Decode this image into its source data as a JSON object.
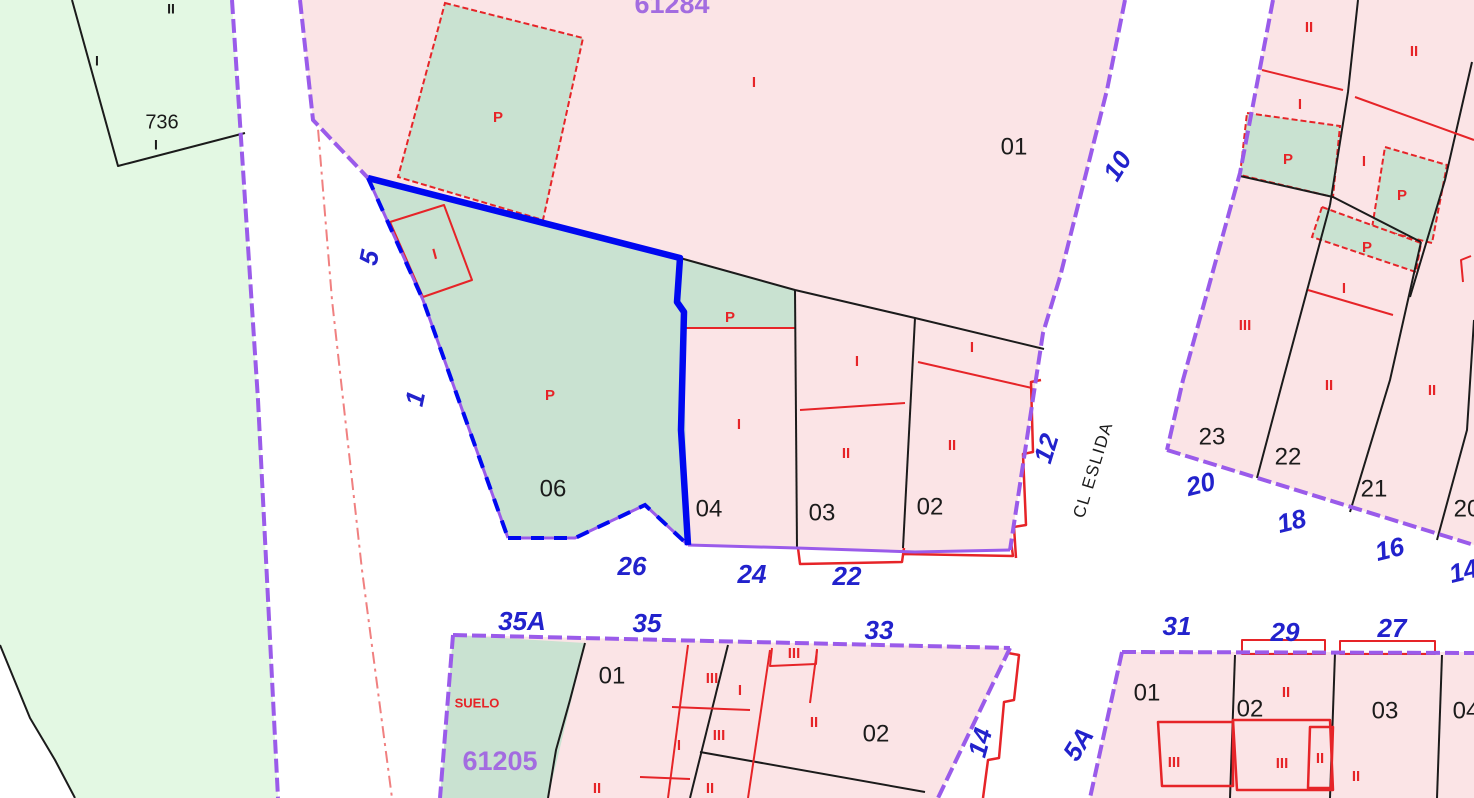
{
  "map_type": "cadastral-parcel-map",
  "palette": {
    "parcel_pink": "#fbe4e6",
    "parcel_sage_green": "#c9e2d1",
    "rural_green": "#e3f8e3",
    "road_white": "#ffffff",
    "boundary_purple": "#9a5bea",
    "block_number_purple": "#a36ce0",
    "street_number_blue": "#2222cc",
    "selection_blue": "#0008f0",
    "subparcel_red": "#e62428",
    "line_black": "#1b1b1b"
  },
  "street": {
    "name": "CL ESLIDA"
  },
  "blocks": {
    "top_center": "61284",
    "bottom_left": "61205"
  },
  "selected_parcel": "06",
  "labels": {
    "black": [
      "736",
      "II",
      "I",
      "I",
      "01",
      "06",
      "04",
      "03",
      "02",
      "23",
      "22",
      "21",
      "20",
      "01",
      "02",
      "01",
      "02",
      "03",
      "04",
      "CL ESLIDA"
    ],
    "blue": [
      "26",
      "24",
      "22",
      "35A",
      "35",
      "33",
      "31",
      "29",
      "27",
      "20",
      "18",
      "16",
      "14",
      "12",
      "10",
      "5",
      "1",
      "5A",
      "14"
    ],
    "purple": [
      "61284",
      "61205"
    ],
    "red": [
      "P",
      "P",
      "P",
      "I",
      "I",
      "I",
      "I",
      "II",
      "I",
      "II",
      "II",
      "II",
      "I",
      "P",
      "I",
      "P",
      "P",
      "I",
      "III",
      "II",
      "II",
      "SUELO",
      "III",
      "I",
      "III",
      "II",
      "III",
      "I",
      "II",
      "II",
      "II",
      "III",
      "III",
      "II",
      "II"
    ]
  }
}
